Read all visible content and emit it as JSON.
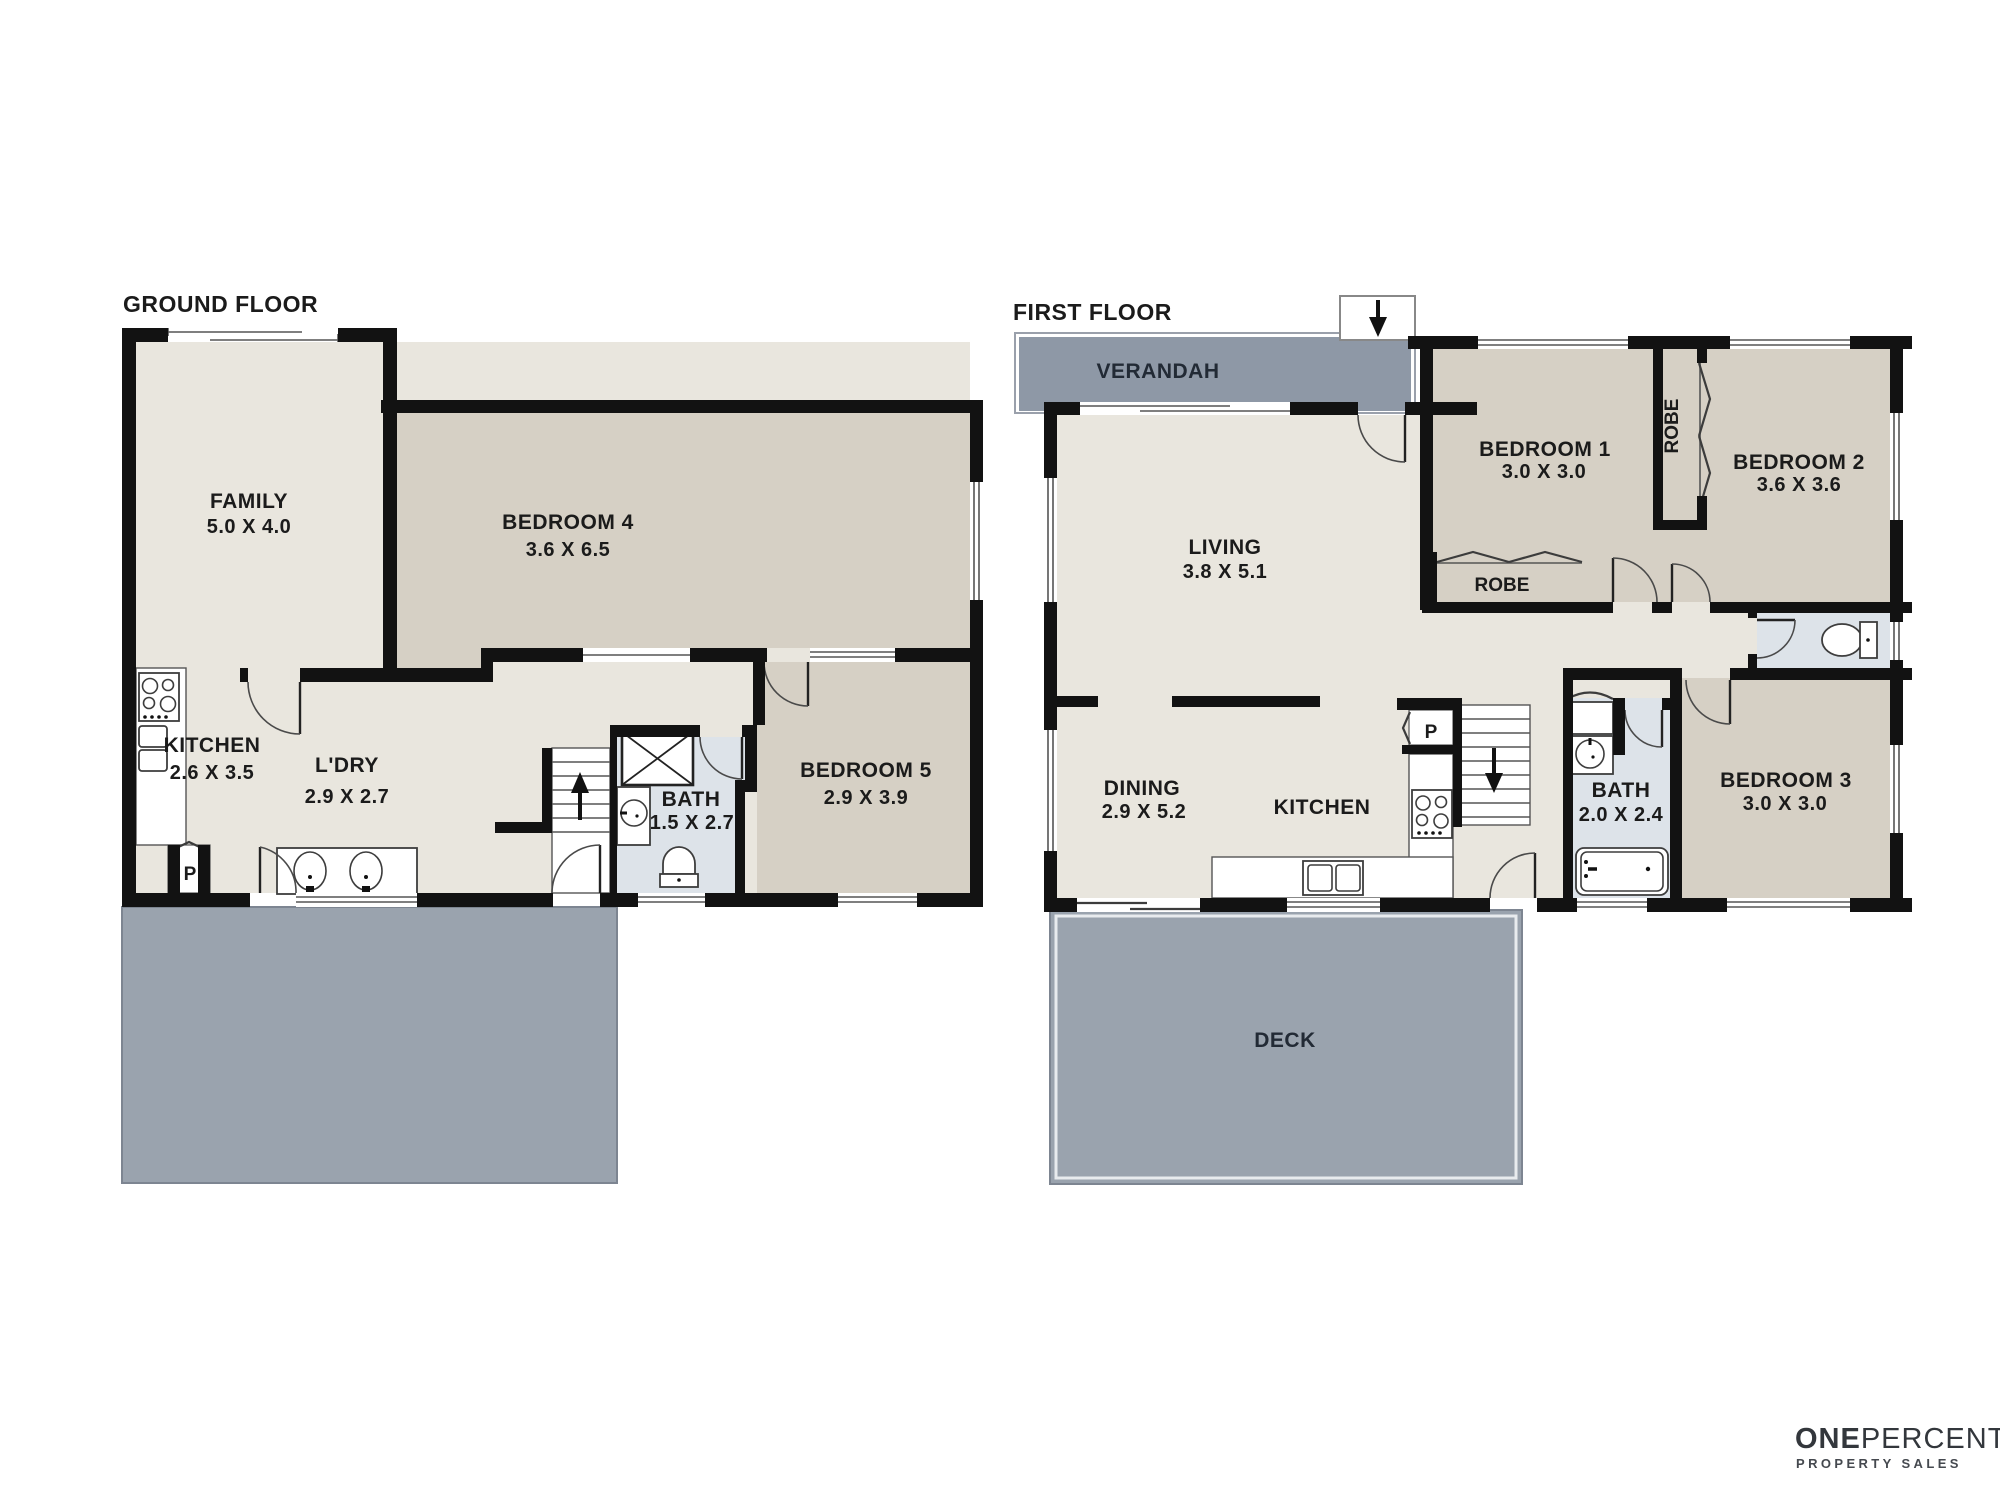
{
  "titles": {
    "ground": "GROUND FLOOR",
    "first": "FIRST FLOOR"
  },
  "ground_floor": {
    "rooms": {
      "family": {
        "name": "FAMILY",
        "dims": "5.0 X 4.0"
      },
      "bedroom4": {
        "name": "BEDROOM 4",
        "dims": "3.6 X 6.5"
      },
      "kitchen": {
        "name": "KITCHEN",
        "dims": "2.6 X 3.5"
      },
      "laundry": {
        "name": "L'DRY",
        "dims": "2.9 X 2.7"
      },
      "bath": {
        "name": "BATH",
        "dims": "1.5 X 2.7"
      },
      "bedroom5": {
        "name": "BEDROOM 5",
        "dims": "2.9 X 3.9"
      },
      "pantry": {
        "label": "P"
      }
    }
  },
  "first_floor": {
    "rooms": {
      "verandah": {
        "name": "VERANDAH"
      },
      "living": {
        "name": "LIVING",
        "dims": "3.8 X 5.1"
      },
      "bedroom1": {
        "name": "BEDROOM 1",
        "dims": "3.0 X 3.0"
      },
      "bedroom2": {
        "name": "BEDROOM 2",
        "dims": "3.6 X 3.6"
      },
      "bedroom3": {
        "name": "BEDROOM 3",
        "dims": "3.0 X 3.0"
      },
      "robe_vertical": {
        "name": "ROBE"
      },
      "robe_bed1": {
        "name": "ROBE"
      },
      "dining": {
        "name": "DINING",
        "dims": "2.9 X 5.2"
      },
      "kitchen": {
        "name": "KITCHEN"
      },
      "bath": {
        "name": "BATH",
        "dims": "2.0 X 2.4"
      },
      "bedroom3_dims_note": "",
      "deck": {
        "name": "DECK"
      },
      "pantry": {
        "label": "P"
      }
    }
  },
  "logo": {
    "one": "ONE",
    "percent": "PERCENT",
    "tagline": "PROPERTY SALES"
  },
  "colors": {
    "wall": "#121212",
    "room_cream": "#e9e6de",
    "room_taupe": "#d6d0c5",
    "room_bath": "#dde3e9",
    "deck": "#9aa3ae",
    "verandah": "#8e98a6",
    "line": "#555555",
    "text": "#1b1b1b",
    "logo": "#33373c"
  }
}
